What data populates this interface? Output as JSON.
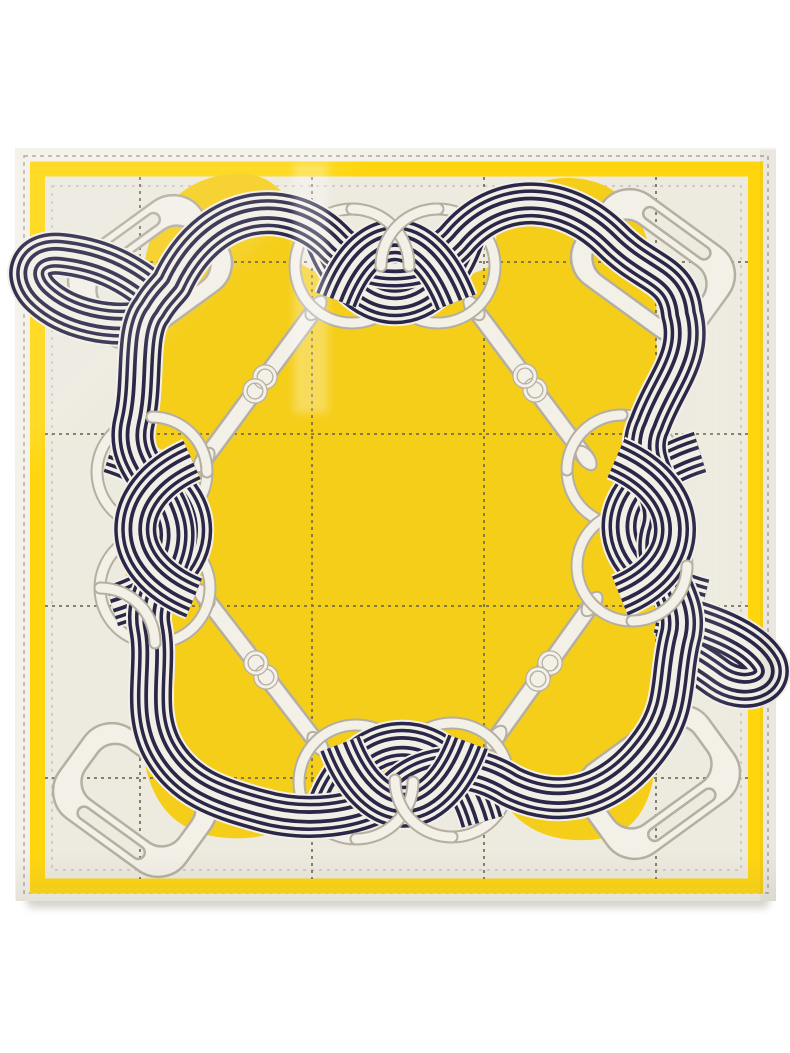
{
  "page": {
    "background": "#FFFFFF"
  },
  "scarf": {
    "kind": "square silk twill scarf, equestrian print",
    "aria_label": "Square silk scarf printed with navy and cream striped ribbons knotted through white rings, snaffle bits and stirrups around a bright yellow centre panel, framed by a yellow border stripe on a cream ground with dashed windowpane checks",
    "palette": {
      "hem": "#F3F1E9",
      "field": "#EDEADF",
      "border_yellow": "#FFD60E",
      "centre_yellow": "#F5CE1A",
      "ribbon_navy": "#2A2748",
      "ribbon_cream": "#F2EFE6",
      "hardware_white": "#F3F0E8",
      "hardware_outline": "#B5AFA2",
      "grid_dash": "#6E6549",
      "stitch": "#9B948A",
      "shadow": "#CBC7BC"
    },
    "motifs": {
      "rings": 8,
      "stirrups": 4,
      "snaffle_bits": 4,
      "ribbon_knots": 4
    }
  }
}
